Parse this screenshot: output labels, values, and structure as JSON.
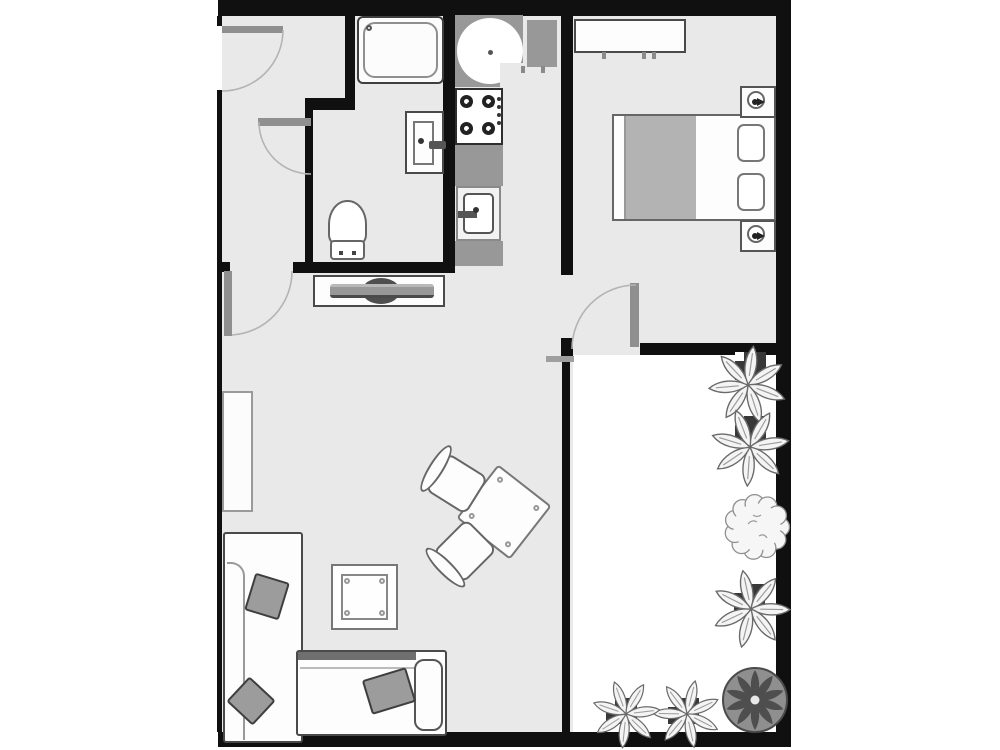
{
  "meta": {
    "type": "floor-plan",
    "description": "Monochrome apartment floor plan: hallway, bathroom, galley kitchen, bedroom, living room and a planted patio",
    "canvas": {
      "width": 1000,
      "height": 750
    }
  },
  "palette": {
    "wall": "#101010",
    "floor": "#e9e9e9",
    "patio_floor": "#ffffff",
    "furniture_fill": "#fdfdfd",
    "outline": "#4a4a4a",
    "door_leaf": "#8f8f8f",
    "door_arc": "#b4b4b4",
    "counter": "#989898",
    "blanket": "#b3b3b3",
    "tv_dark": "#4f4f4f",
    "plant_pot": "#383838",
    "palm": "#8f8f8f",
    "bush_stroke": "#8f8f8f"
  },
  "rooms": [
    {
      "id": "hallway",
      "name": "Entrance hallway"
    },
    {
      "id": "bathroom",
      "name": "Bathroom"
    },
    {
      "id": "kitchen",
      "name": "Kitchen"
    },
    {
      "id": "bedroom",
      "name": "Bedroom"
    },
    {
      "id": "living",
      "name": "Living room"
    },
    {
      "id": "patio",
      "name": "Patio terrace"
    }
  ],
  "doors": [
    {
      "id": "entrance-door",
      "name": "Entrance door",
      "location": "top of left wall",
      "swing": "quarter-arc inward"
    },
    {
      "id": "bathroom-door",
      "name": "Bathroom door",
      "location": "bathroom zigzag wall",
      "swing": "quarter-arc inward"
    },
    {
      "id": "living-room-door",
      "name": "Living room door",
      "location": "hallway/living wall",
      "swing": "quarter-arc into living room"
    },
    {
      "id": "terrace-door",
      "name": "Bedroom terrace door",
      "location": "bedroom south wall",
      "swing": "quarter-arc into bedroom"
    }
  ],
  "fixtures": {
    "bathroom": [
      "bathtub",
      "washbasin with faucet",
      "toilet"
    ],
    "kitchen": [
      "corner counter with round basin",
      "stove with 4 burners",
      "counter",
      "kitchen sink with faucet",
      "counter"
    ],
    "bedroom": [
      "wardrobe",
      "double bed",
      "gray blanket",
      "2 pillows",
      "2 nightstands with lamps"
    ],
    "living": [
      "TV stand with flat TV",
      "wall shelf",
      "corner sofa (2 sections)",
      "3 throw pillows",
      "coffee table",
      "dining table (rotated)",
      "2 dining chairs"
    ],
    "patio": [
      "5 potted flower plants",
      "round bush",
      "round palm planter"
    ]
  },
  "counts": {
    "rooms": 6,
    "doors": 4,
    "burners": 4,
    "dining_chairs": 2,
    "bed_pillows": 2,
    "throw_pillows": 3,
    "patio_plants": 7
  }
}
